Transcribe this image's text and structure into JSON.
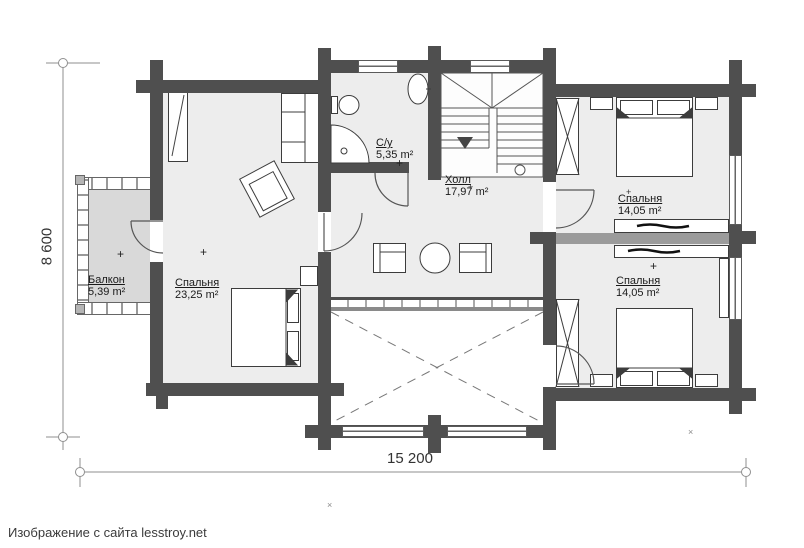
{
  "footer": {
    "caption": "Изображение с сайта lesstroy.net"
  },
  "dimensions": {
    "width_label": "15 200",
    "height_label": "8 600"
  },
  "rooms": [
    {
      "id": "balcony",
      "name": "Балкон",
      "area": "5,39 m²"
    },
    {
      "id": "bedroom-left",
      "name": "Спальня",
      "area": "23,25 m²"
    },
    {
      "id": "bathroom",
      "name": "С/у",
      "area": "5,35 m²"
    },
    {
      "id": "hall",
      "name": "Холл",
      "area": "17,97 m²"
    },
    {
      "id": "bedroom-top-right",
      "name": "Спальня",
      "area": "14,05 m²"
    },
    {
      "id": "bedroom-bottom-right",
      "name": "Спальня",
      "area": "14,05 m²"
    }
  ],
  "markers": {
    "plus": "+",
    "cross": "×"
  },
  "colors": {
    "wall": "#4f4f4f",
    "room_fill": "#ededed",
    "balcony_fill": "#d9d9d9",
    "partition": "#9b9b9b"
  }
}
